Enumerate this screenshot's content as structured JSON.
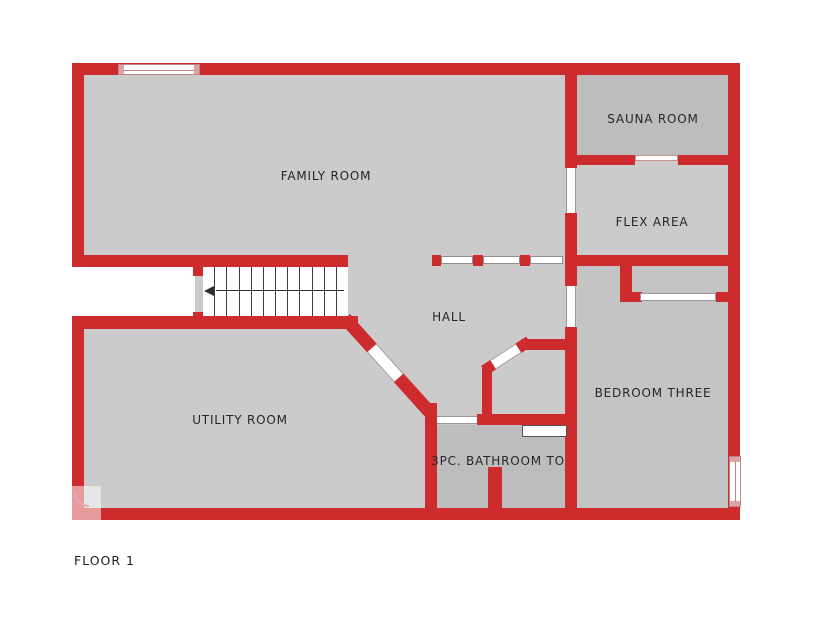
{
  "plan": {
    "floor_label": "FLOOR 1",
    "rooms": [
      {
        "id": "family-room",
        "label": "FAMILY ROOM"
      },
      {
        "id": "sauna-room",
        "label": "SAUNA ROOM"
      },
      {
        "id": "flex-area",
        "label": "FLEX AREA"
      },
      {
        "id": "hall",
        "label": "HALL"
      },
      {
        "id": "utility-room",
        "label": "UTILITY ROOM"
      },
      {
        "id": "bedroom-three",
        "label": "BEDROOM THREE"
      },
      {
        "id": "bathroom",
        "label": "3PC. BATHROOM TO"
      }
    ],
    "stairs": {
      "treads": 12,
      "direction_arrow": "left"
    },
    "colors": {
      "wall": "#cd2b2e",
      "wall_accent_pink": "#dda4a4",
      "floor": "#cbcbcb",
      "floor_dark": "#bdbdbd",
      "floor_bedroom": "#c4c4c4",
      "label_text": "#262626",
      "background": "#ffffff"
    }
  }
}
